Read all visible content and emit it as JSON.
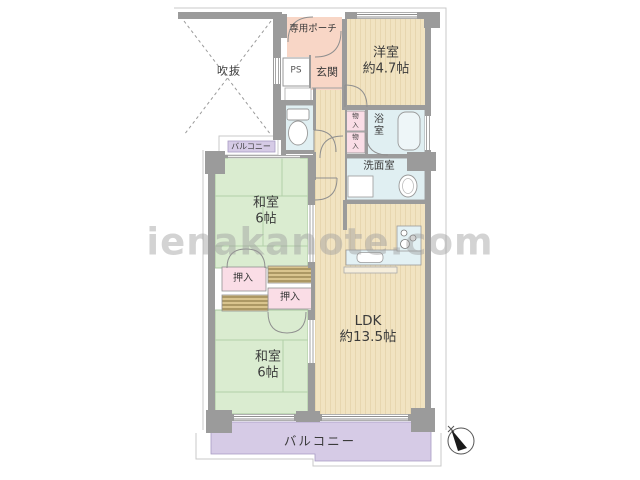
{
  "watermark": "ienakanote.com",
  "rooms": {
    "void": {
      "label": "吹抜"
    },
    "private_porch": {
      "label": "専用ポーチ"
    },
    "pipe_space": {
      "label": "PS"
    },
    "entrance": {
      "label": "玄関"
    },
    "western_room": {
      "label": "洋室",
      "size": "約4.7帖"
    },
    "storage_upper": {
      "label": "物入"
    },
    "storage_lower": {
      "label": "物入"
    },
    "bathroom": {
      "label": "浴室"
    },
    "washroom": {
      "label": "洗面室"
    },
    "japanese_room_north": {
      "label": "和室",
      "size": "6帖"
    },
    "closet_north": {
      "label": "押入"
    },
    "closet_south": {
      "label": "押入"
    },
    "japanese_room_south": {
      "label": "和室",
      "size": "6帖"
    },
    "ldk": {
      "label": "LDK",
      "size": "約13.5帖"
    },
    "balcony_side": {
      "label": "バルコニー"
    },
    "balcony_main": {
      "label": "バルコニー"
    }
  },
  "colors": {
    "wall": "#9b9b9b",
    "wood_room": "#f1e3c1",
    "tatami_room": "#daecd0",
    "wet_room": "#e0eff2",
    "closet_pink": "#fadde6",
    "porch_pink": "#f8d6c6",
    "balcony_purple": "#d6cbe6",
    "watermark_gray": "#9e9e9e"
  }
}
